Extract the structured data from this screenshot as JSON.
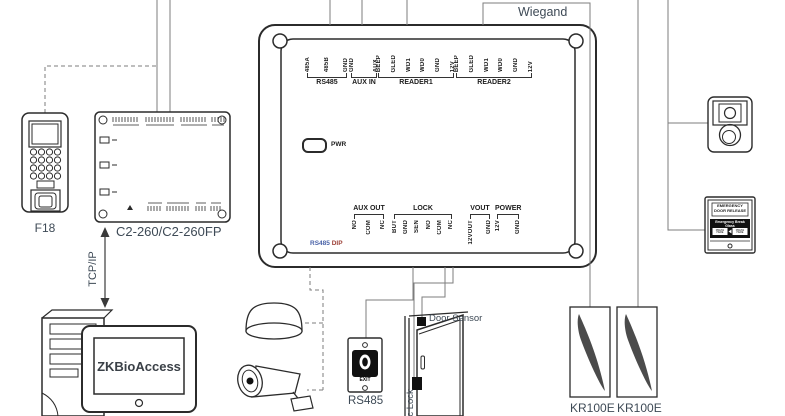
{
  "labels": {
    "wiegand": "Wiegand",
    "tcpip": "TCP/IP",
    "f18": "F18",
    "c2260": "C2-260/C2-260FP",
    "zkbioaccess": "ZKBioAccess",
    "exit_button_bus": "RS485",
    "door_sensor": "Door Sensor",
    "magnetic_lock_partial": "ic Lock",
    "kr100e_left": "KR100E",
    "kr100e_right": "KR100E"
  },
  "board": {
    "pwr_led": "PWR",
    "dip_rs485": "RS485",
    "dip_dip": "DIP",
    "top_groups": [
      {
        "name": "RS485",
        "pins": [
          "485A",
          "485B",
          "GND"
        ]
      },
      {
        "name": "AUX IN",
        "pins": [
          "GND",
          "AUX"
        ]
      },
      {
        "name": "READER1",
        "pins": [
          "BEEP",
          "GLED",
          "WD1",
          "WD0",
          "GND",
          "12V"
        ]
      },
      {
        "name": "READER2",
        "pins": [
          "BEEP",
          "GLED",
          "WD1",
          "WD0",
          "GND",
          "12V"
        ]
      }
    ],
    "bottom_groups": [
      {
        "name": "AUX OUT",
        "pins": [
          "NO",
          "COM",
          "NC"
        ]
      },
      {
        "name": "LOCK",
        "pins": [
          "BUT",
          "GND",
          "SEN",
          "NO",
          "COM",
          "NC"
        ]
      },
      {
        "name": "VOUT",
        "pins": [
          "12VOUT",
          "GND"
        ]
      },
      {
        "name": "POWER",
        "pins": [
          "12V",
          "GND"
        ]
      }
    ]
  },
  "exit_button": {
    "label": "EXIT"
  },
  "emergency_device": {
    "line1": "EMERGENCY",
    "line2": "DOOR RELEASE",
    "band": "Emergency Break Glass",
    "press_left": "PRESS HERE",
    "press_right": "PRESS HERE"
  },
  "colors": {
    "label": "#3e4a56",
    "wire": "#7d7d7d",
    "ink": "#2b2b2b",
    "dip_blue": "#4a63a8",
    "dip_red": "#9c3f35",
    "swoosh": "#4b4b4b"
  }
}
